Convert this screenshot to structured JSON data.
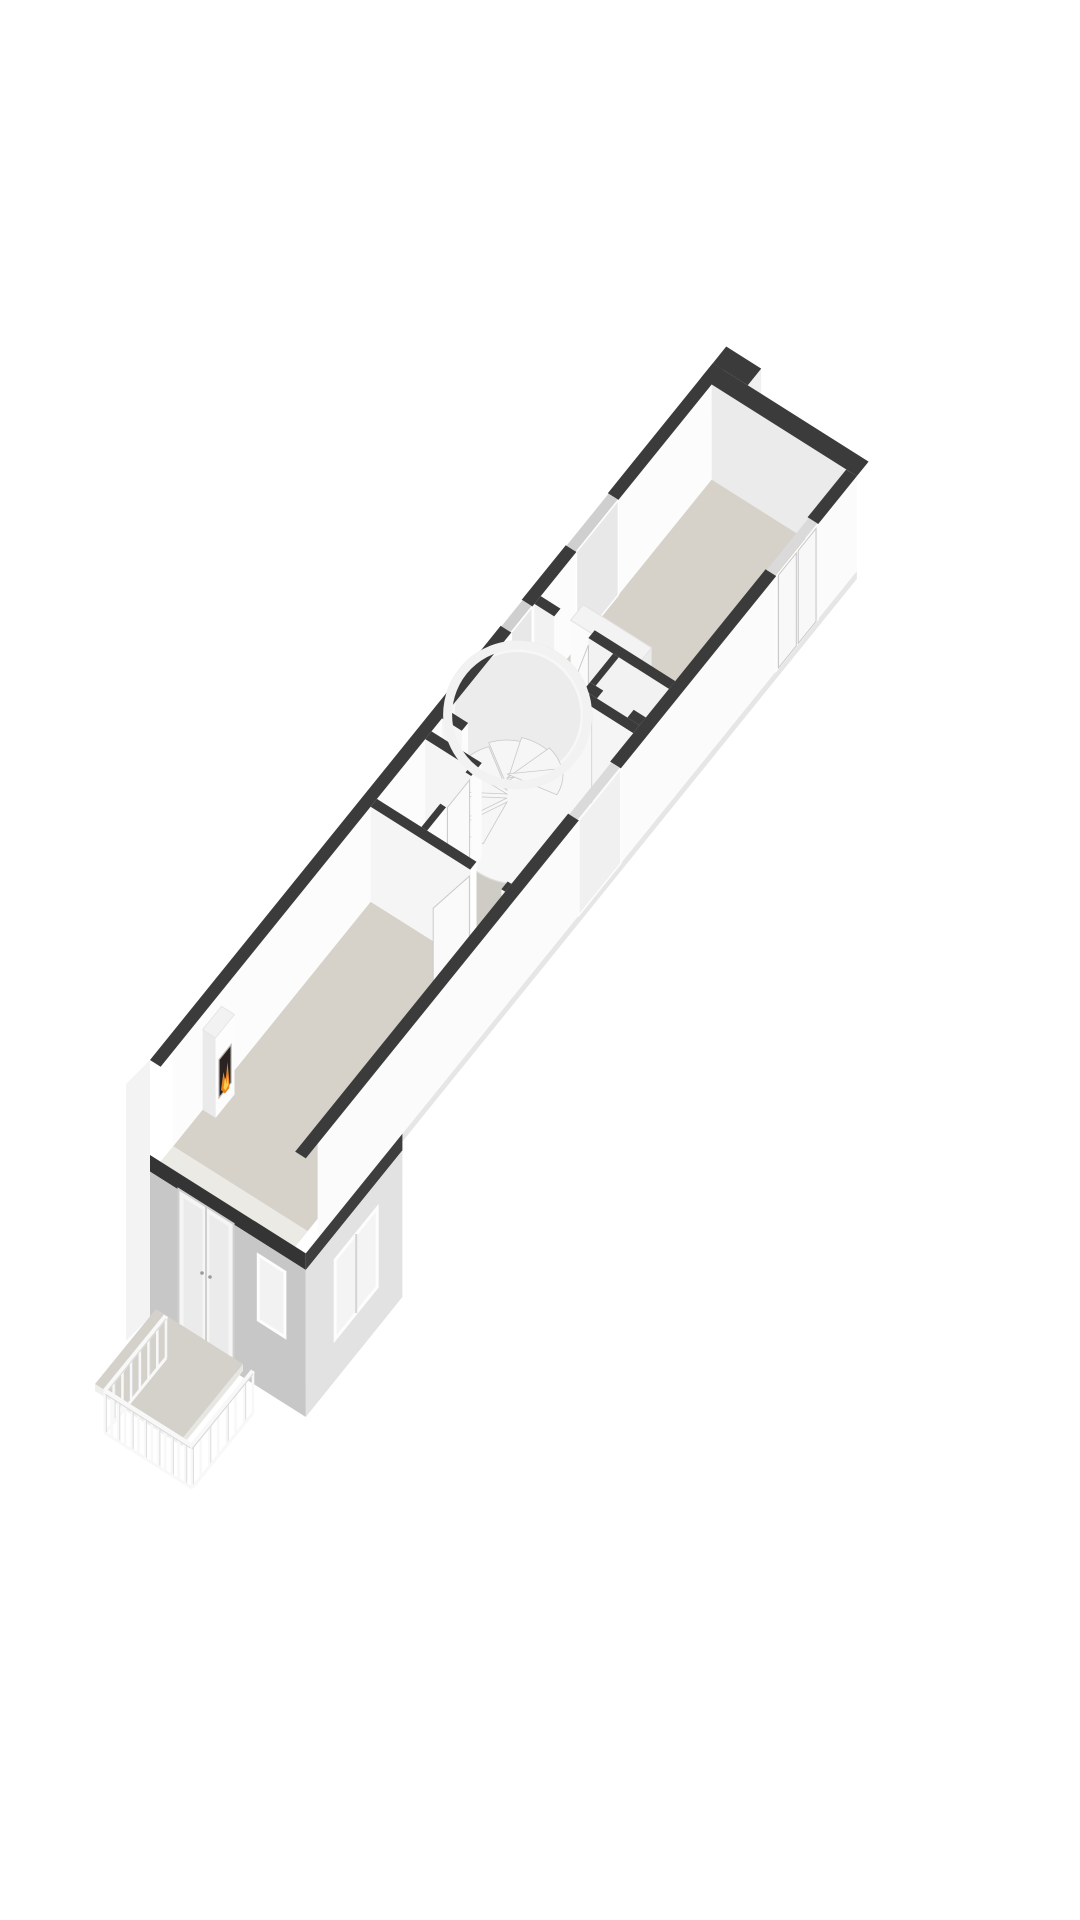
{
  "scene": {
    "kind": "isometric-3d-floorplan-render",
    "background": "#ffffff",
    "rooms": [
      {
        "name": "living-room",
        "features": [
          "fireplace-with-fire",
          "door-to-hall",
          "balcony-below"
        ]
      },
      {
        "name": "hallway",
        "features": [
          "spiral-staircase",
          "closet",
          "balcony-door-opening"
        ]
      },
      {
        "name": "closet-room",
        "features": [
          "door-to-hall"
        ]
      },
      {
        "name": "bedroom",
        "features": [
          "wardrobe",
          "window-slots",
          "double-doors"
        ]
      }
    ],
    "exterior": [
      "grey-street-facade",
      "french-doors",
      "facade-window",
      "side-window",
      "balcony-with-railing",
      "roof-notch"
    ]
  },
  "colors": {
    "bg": "#ffffff",
    "floor": "#d6d2c9",
    "floor_hall": "#cfccc6",
    "floor_light": "#e7e6e2",
    "trim": "#ebeae5",
    "wall_top": "#3b3b3b",
    "slab": "#343434",
    "wall_bright": "#fcfcfc",
    "wall_lit": "#f5f5f5",
    "wall_shade": "#ebebeb",
    "wall_inner": "#f2f2f2",
    "facade": "#c7c7c7",
    "facade_side": "#e2e2e2",
    "glass": "#eff0ef",
    "window_slot": "#cfcfcf",
    "gap_glass": "#dadada",
    "frame": "#c9c9c9",
    "door": "#fafafa",
    "cylinder": "#f7f7f7",
    "cylinder_top": "#ececec",
    "stair": "#f6f6f6",
    "railing": "#f8f8f8",
    "fire_dark": "#2a2321",
    "fire_orange": "#e8821e",
    "fire_yellow": "#f7cf4e"
  },
  "spiral_stairs": {
    "cx": 497,
    "cy": 747,
    "r": 56,
    "steps": 8,
    "start_deg": 115,
    "step_deg": 34,
    "rise": 4
  },
  "balcony_railing": {
    "top": 48,
    "bottom": 6,
    "edges": [
      {
        "from": [
          146,
          1254
        ],
        "to": [
          85,
          1329
        ],
        "pickets": 7
      },
      {
        "from": [
          85,
          1329
        ],
        "to": [
          172,
          1384
        ],
        "pickets": 13
      },
      {
        "from": [
          172,
          1384
        ],
        "to": [
          233,
          1309
        ],
        "pickets": 7
      }
    ]
  }
}
